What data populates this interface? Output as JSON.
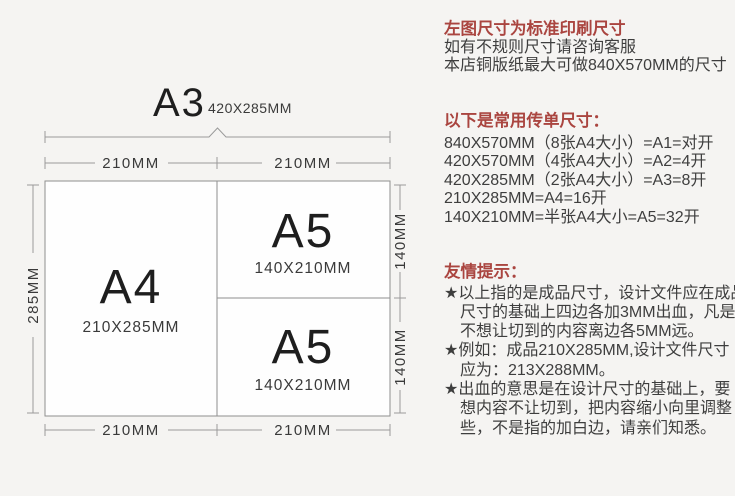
{
  "colors": {
    "background": "#f5f4f2",
    "paper_fill": "#fefefe",
    "line_gray": "#9a9a9a",
    "accent_red": "#aa4540",
    "body_text": "#3e3e3e",
    "label_text": "#1e1e1e"
  },
  "diagram": {
    "a3_label": "A3",
    "a3_size": "420X285MM",
    "a4_label": "A4",
    "a4_size": "210X285MM",
    "a5_top_label": "A5",
    "a5_top_size": "140X210MM",
    "a5_bottom_label": "A5",
    "a5_bottom_size": "140X210MM",
    "dim_top_left": "210MM",
    "dim_top_right": "210MM",
    "dim_bottom_left": "210MM",
    "dim_bottom_right": "210MM",
    "dim_left": "285MM",
    "dim_right_top": "140MM",
    "dim_right_bottom": "140MM"
  },
  "info": {
    "intro": {
      "title": "左图尺寸为标准印刷尺寸",
      "lines": [
        "如有不规则尺寸请咨询客服",
        "本店铜版纸最大可做840X570MM的尺寸"
      ]
    },
    "sizes": {
      "title": "以下是常用传单尺寸：",
      "lines": [
        "840X570MM（8张A4大小）=A1=对开",
        "420X570MM（4张A4大小）=A2=4开",
        "420X285MM（2张A4大小）=A3=8开",
        "210X285MM=A4=16开",
        "140X210MM=半张A4大小=A5=32开"
      ]
    },
    "tips": {
      "title": "友情提示：",
      "lines": [
        "★以上指的是成品尺寸，设计文件应在成品",
        "尺寸的基础上四边各加3MM出血，凡是",
        "不想让切到的内容离边各5MM远。",
        "★例如：成品210X285MM,设计文件尺寸",
        "应为：213X288MM。",
        "★出血的意思是在设计尺寸的基础上，要",
        "想内容不让切到，把内容缩小向里调整",
        "些，不是指的加白边，请亲们知悉。"
      ]
    }
  }
}
